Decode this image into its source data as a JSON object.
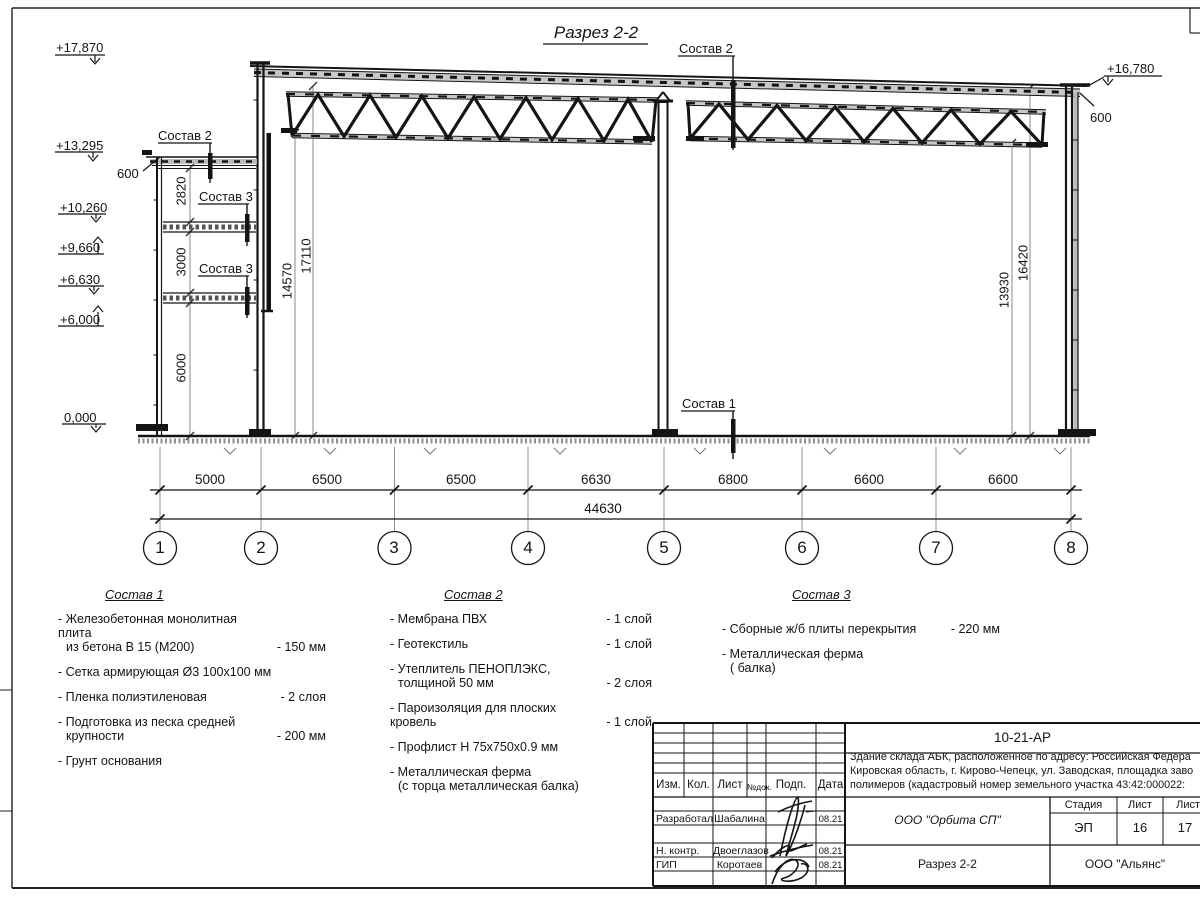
{
  "title": "Разрез 2-2",
  "elevations": {
    "e17870": "+17,870",
    "e13295": "+13,295",
    "e10260": "+10,260",
    "e9660": "+9,660",
    "e6630": "+6,630",
    "e6000": "+6,000",
    "e0": "0,000",
    "e16780": "+16,780",
    "left600": "600",
    "right600": "600"
  },
  "vdims": {
    "d2820": "2820",
    "d3000": "3000",
    "d6000": "6000",
    "d14570": "14570",
    "d17110": "17110",
    "d13930": "13930",
    "d16420": "16420"
  },
  "callouts": {
    "s1": "Состав 1",
    "s2": "Состав 2",
    "s3": "Состав 3"
  },
  "axis_dims": [
    "5000",
    "6500",
    "6500",
    "6630",
    "6800",
    "6600",
    "6600"
  ],
  "total_dim": "44630",
  "axes": [
    "1",
    "2",
    "3",
    "4",
    "5",
    "6",
    "7",
    "8"
  ],
  "notes": {
    "s1": {
      "title": "Состав 1",
      "items": [
        {
          "l1": "- Железобетонная  монолитная плита",
          "l2": "из бетона В 15 (М200)",
          "v": "- 150 мм"
        },
        {
          "l1": "- Сетка армирующая Ø3 100х100 мм"
        },
        {
          "l1": "- Пленка полиэтиленовая",
          "v": "-  2 слоя"
        },
        {
          "l1": "- Подготовка из песка средней",
          "l2": "крупности",
          "v": "- 200 мм"
        },
        {
          "l1": "- Грунт основания"
        }
      ]
    },
    "s2": {
      "title": "Состав 2",
      "items": [
        {
          "l1": "- Мембрана ПВХ",
          "v": "- 1 слой"
        },
        {
          "l1": "- Геотекстиль",
          "v": "- 1 слой"
        },
        {
          "l1": "- Утеплитель ПЕНОПЛЭКС,",
          "l2": "толщиной 50 мм",
          "v": "- 2 слоя"
        },
        {
          "l1": "- Пароизоляция для плоских кровель",
          "v": "- 1 слой"
        },
        {
          "l1": "- Профлист Н 75х750х0.9 мм"
        },
        {
          "l1": "- Металлическая ферма",
          "l2": "(с торца металлическая балка)"
        }
      ]
    },
    "s3": {
      "title": "Состав 3",
      "items": [
        {
          "l1": "- Сборные ж/б плиты перекрытия",
          "v": "- 220 мм"
        },
        {
          "l1": "- Металлическая ферма",
          "l2": "( балка)"
        }
      ]
    }
  },
  "titleblock": {
    "code": "10-21-АР",
    "desc1": "Здание склада АБК, расположенное по адресу: Российская Федера",
    "desc2": "Кировская область, г. Кирово-Чепецк, ул. Заводская, площадка заво",
    "desc3": "полимеров (кадастровый номер земельного участка 43:42:000022:",
    "cols": {
      "izm": "Изм.",
      "kol": "Кол.",
      "list": "Лист",
      "ndoc": "№док.",
      "podp": "Подп.",
      "data": "Дата"
    },
    "rows": [
      {
        "role": "Разработал",
        "name": "Шабалина",
        "date": "08.21"
      },
      {
        "role": "Н. контр.",
        "name": "Двоеглазов",
        "date": "08.21"
      },
      {
        "role": "ГИП",
        "name": "Коротаев",
        "date": "08.21"
      }
    ],
    "org": "ООО \"Орбита СП\"",
    "stage_label": "Стадия",
    "sheet_label": "Лист",
    "sheets_label": "Листов",
    "stage": "ЭП",
    "sheet": "16",
    "sheets": "17",
    "section": "Разрез 2-2",
    "company": "ООО \"Альянс\""
  }
}
